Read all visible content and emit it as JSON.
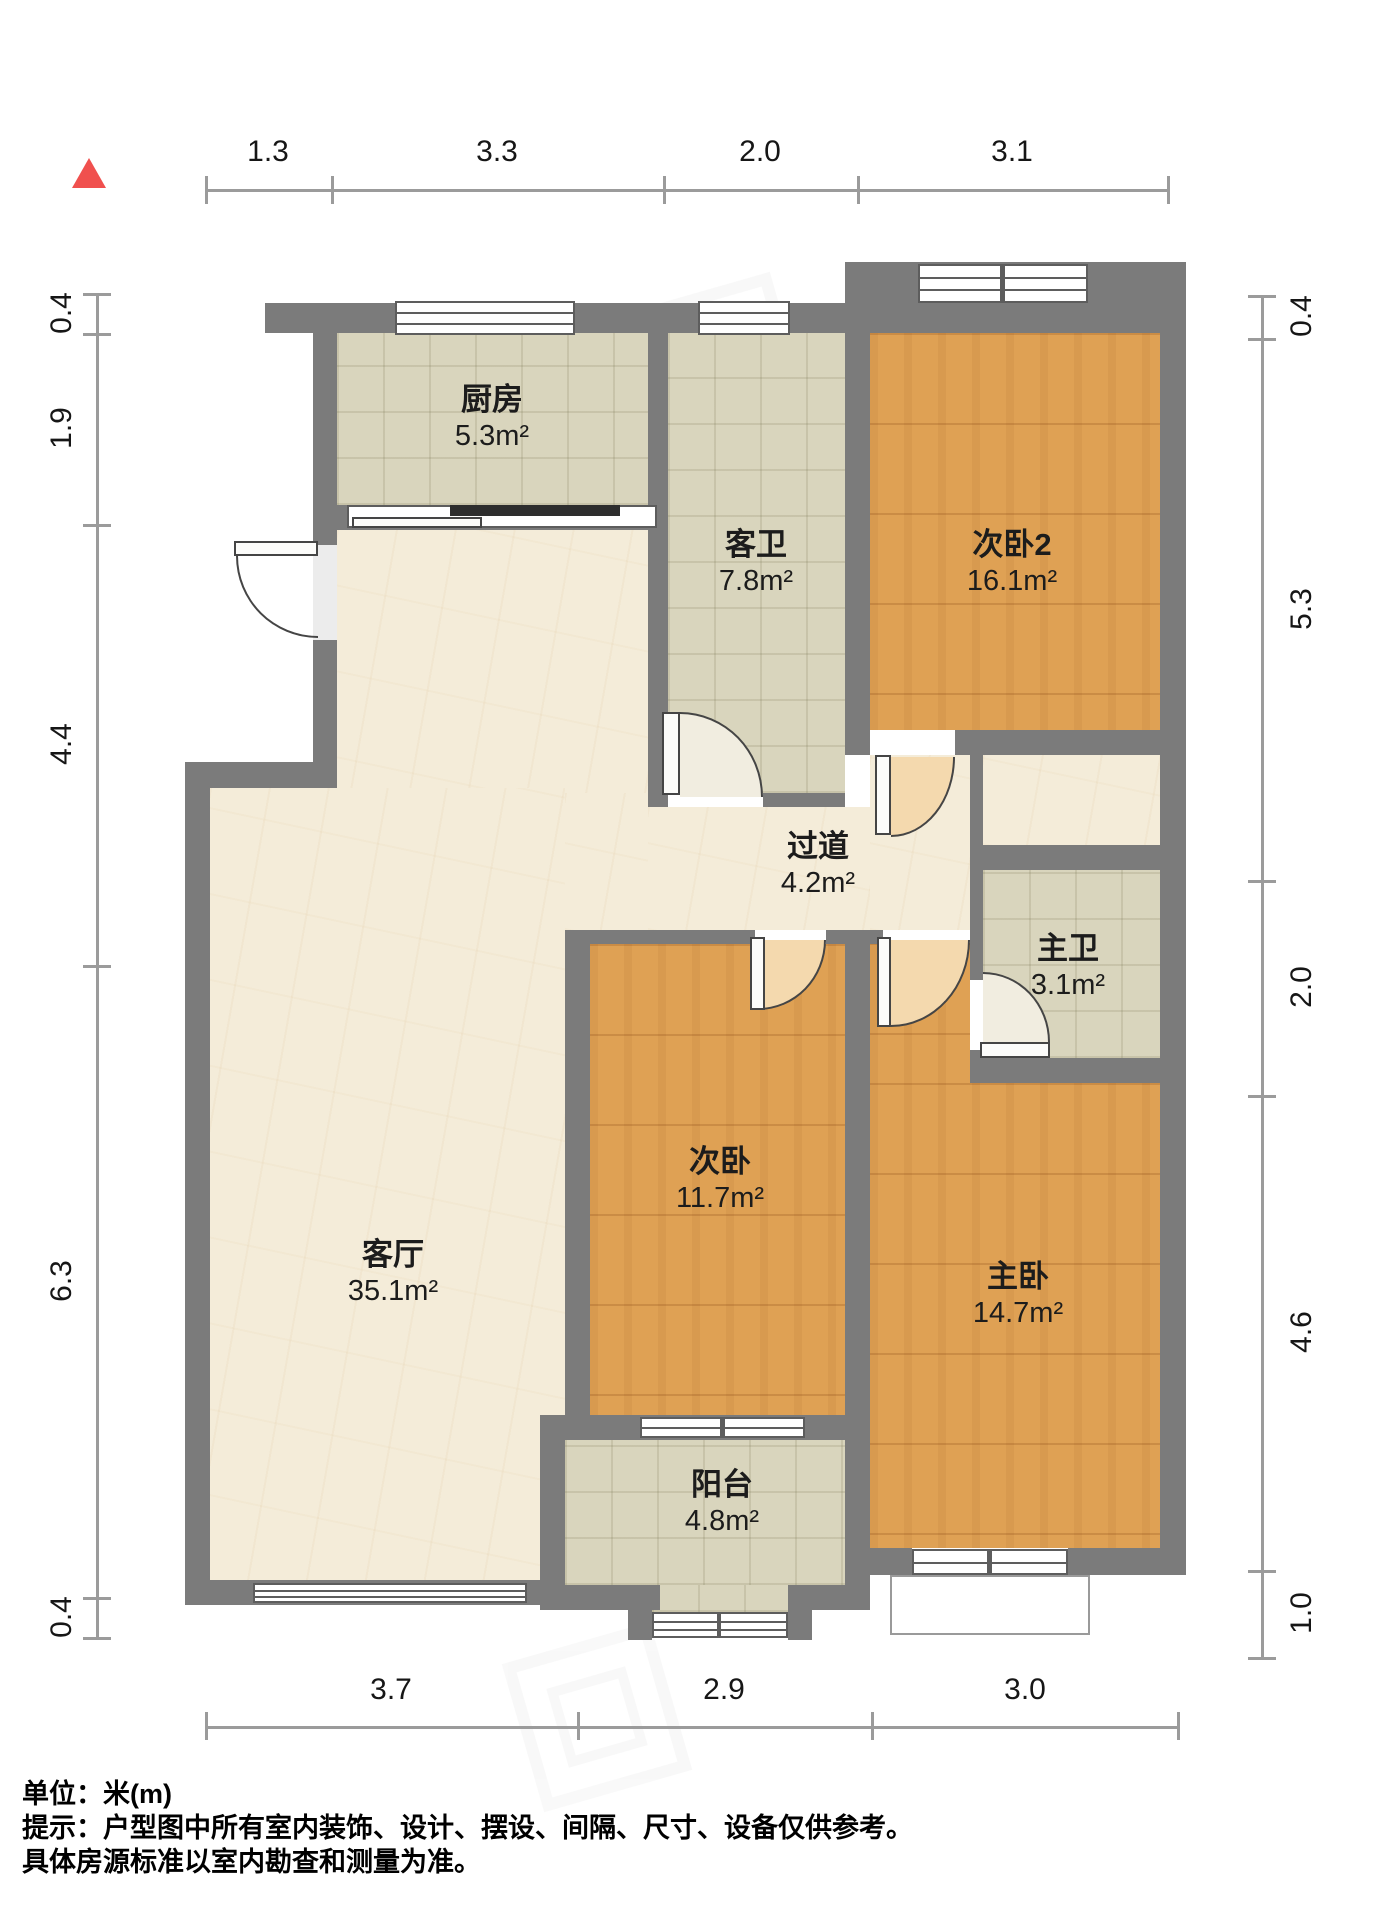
{
  "dimensions": {
    "top": [
      "1.3",
      "3.3",
      "2.0",
      "3.1"
    ],
    "left": [
      "0.4",
      "1.9",
      "4.4",
      "6.3",
      "0.4"
    ],
    "right": [
      "0.4",
      "5.3",
      "2.0",
      "4.6",
      "1.0"
    ],
    "bottom": [
      "3.7",
      "2.9",
      "3.0"
    ]
  },
  "rooms": [
    {
      "id": "kitchen",
      "name": "厨房",
      "area": "5.3m²"
    },
    {
      "id": "guest-bath",
      "name": "客卫",
      "area": "7.8m²"
    },
    {
      "id": "bedroom-2",
      "name": "次卧2",
      "area": "16.1m²"
    },
    {
      "id": "hallway",
      "name": "过道",
      "area": "4.2m²"
    },
    {
      "id": "master-bath",
      "name": "主卫",
      "area": "3.1m²"
    },
    {
      "id": "living-room",
      "name": "客厅",
      "area": "35.1m²"
    },
    {
      "id": "bedroom",
      "name": "次卧",
      "area": "11.7m²"
    },
    {
      "id": "master-bedroom",
      "name": "主卧",
      "area": "14.7m²"
    },
    {
      "id": "balcony",
      "name": "阳台",
      "area": "4.8m²"
    }
  ],
  "footer": {
    "unit_label": "单位：米(m)",
    "tip_line1": "提示：户型图中所有室内装饰、设计、摆设、间隔、尺寸、设备仅供参考。",
    "tip_line2": "具体房源标准以室内勘查和测量为准。"
  },
  "colors": {
    "wall": "#7b7b7b",
    "wood_floor": "#dfa154",
    "tile_floor": "#d9d5bd",
    "marble_floor": "#f4ecd9",
    "north_arrow": "#f0504e",
    "dim_line": "#9b9b9b"
  }
}
